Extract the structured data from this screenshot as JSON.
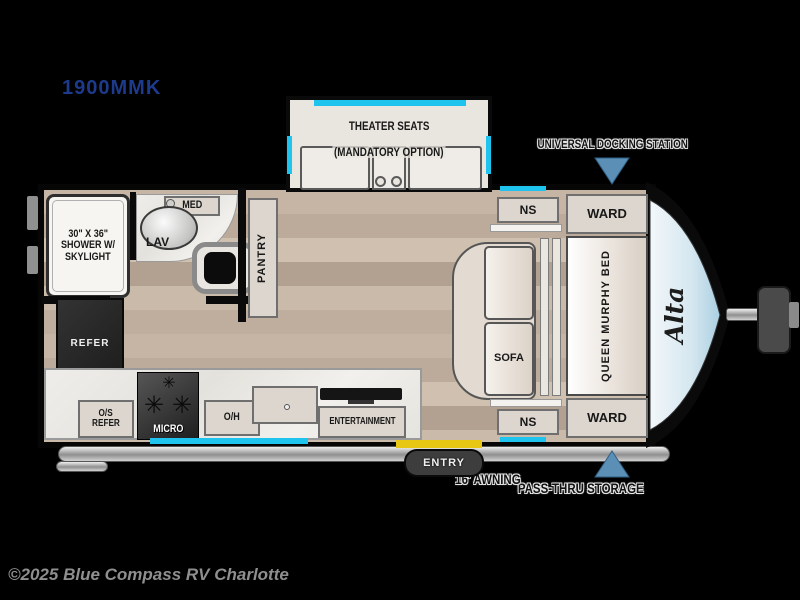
{
  "header": {
    "model_number": "1900MMK"
  },
  "footer": {
    "copyright": "©2025 Blue Compass RV Charlotte"
  },
  "floorplan": {
    "brand_script": "Alta",
    "exterior_labels": {
      "docking_station": "UNIVERSAL DOCKING STATION",
      "awning": "16' AWNING",
      "pass_thru": "PASS-THRU STORAGE"
    },
    "slideout": {
      "line1": "THEATER SEATS",
      "line2": "(MANDATORY OPTION)"
    },
    "bedroom": {
      "ns_top": "NS",
      "ward_top": "WARD",
      "murphy_bed": "QUEEN MURPHY BED",
      "sofa": "SOFA",
      "ns_bottom": "NS",
      "ward_bottom": "WARD"
    },
    "bathroom": {
      "shower_line1": "30\" X 36\"",
      "shower_line2": "SHOWER W/",
      "shower_line3": "SKYLIGHT",
      "med": "MED",
      "lav": "LAV"
    },
    "kitchen": {
      "pantry": "PANTRY",
      "refer": "REFER",
      "os_refer_line1": "O/S",
      "os_refer_line2": "REFER",
      "micro": "MICRO",
      "oh": "O/H",
      "entertainment": "ENTERTAINMENT",
      "entry": "ENTRY"
    },
    "icons": {
      "burner": "✳"
    },
    "colors": {
      "accent_cyan": "#1ec3ee",
      "accent_yellow": "#e8c714",
      "arrow_blue": "#5b8fb5",
      "model_navy": "#1d3a8c",
      "copyright_gray": "#8f8f8f"
    }
  }
}
